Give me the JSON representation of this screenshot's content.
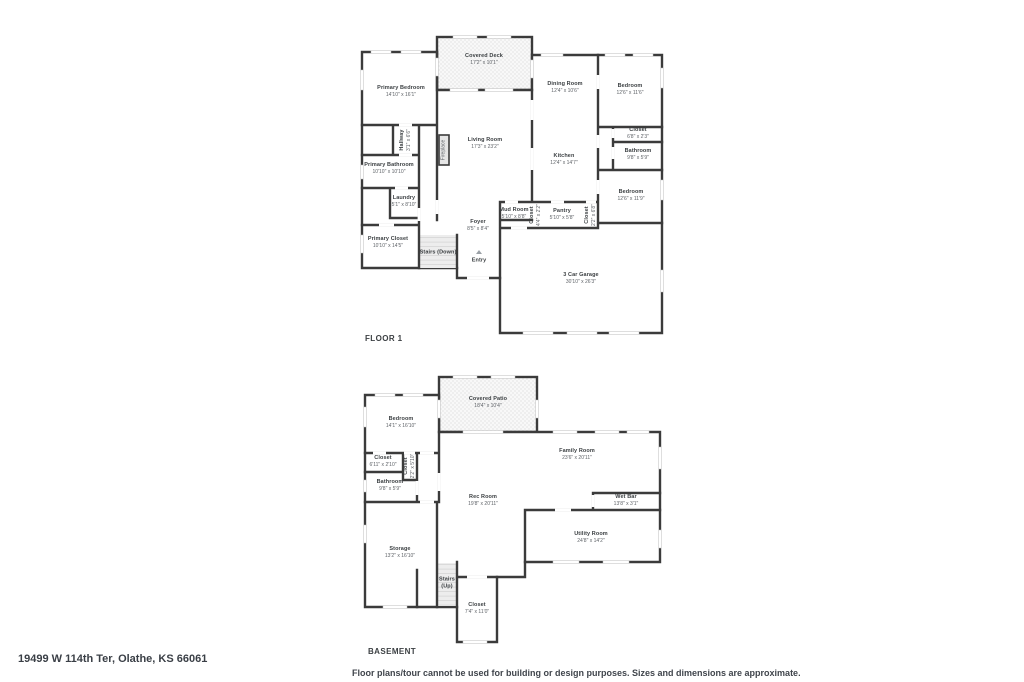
{
  "page": {
    "address": "19499 W 114th Ter, Olathe, KS 66061",
    "disclaimer": "Floor plans/tour cannot be used for building or design purposes. Sizes and dimensions are approximate."
  },
  "floor1": {
    "label": "FLOOR 1",
    "rooms": {
      "covered_deck": {
        "name": "Covered Deck",
        "dims": "17'2\" x 10'1\""
      },
      "primary_bedroom": {
        "name": "Primary Bedroom",
        "dims": "14'10\" x 16'1\""
      },
      "dining_room": {
        "name": "Dining Room",
        "dims": "12'4\" x 10'6\""
      },
      "bedroom_right": {
        "name": "Bedroom",
        "dims": "12'6\" x 11'6\""
      },
      "closet_right": {
        "name": "Closet",
        "dims": "6'8\" x 2'3\""
      },
      "bathroom_right": {
        "name": "Bathroom",
        "dims": "9'8\" x 5'9\""
      },
      "living_room": {
        "name": "Living Room",
        "dims": "17'3\" x 23'2\""
      },
      "kitchen": {
        "name": "Kitchen",
        "dims": "12'4\" x 14'7\""
      },
      "bedroom_lower_right": {
        "name": "Bedroom",
        "dims": "12'6\" x 11'9\""
      },
      "hallway": {
        "name": "Hallway",
        "dims": "3'1\" x 6'6\""
      },
      "primary_bathroom": {
        "name": "Primary Bathroom",
        "dims": "10'10\" x 10'10\""
      },
      "laundry": {
        "name": "Laundry",
        "dims": "5'1\" x 8'10\""
      },
      "primary_closet": {
        "name": "Primary Closet",
        "dims": "10'10\" x 14'5\""
      },
      "stairs_down": {
        "name": "Stairs (Down)",
        "dims": ""
      },
      "foyer": {
        "name": "Foyer",
        "dims": "8'5\" x 8'4\""
      },
      "entry": {
        "name": "Entry",
        "dims": ""
      },
      "mud_room": {
        "name": "Mud Room",
        "dims": "5'10\" x 8'8\""
      },
      "closet_mud": {
        "name": "Closet",
        "dims": "4'4\" x 2'2\""
      },
      "pantry": {
        "name": "Pantry",
        "dims": "5'10\" x 5'8\""
      },
      "closet_pantry": {
        "name": "Closet",
        "dims": "2'2\" x 6'8\""
      },
      "garage": {
        "name": "3 Car Garage",
        "dims": "30'10\" x 26'3\""
      },
      "fireplace": {
        "name": "Fireplace",
        "dims": ""
      }
    }
  },
  "basement": {
    "label": "BASEMENT",
    "rooms": {
      "covered_patio": {
        "name": "Covered Patio",
        "dims": "18'4\" x 10'4\""
      },
      "bedroom": {
        "name": "Bedroom",
        "dims": "14'1\" x 16'10\""
      },
      "closet_a": {
        "name": "Closet",
        "dims": "6'11\" x 2'10\""
      },
      "closet_b": {
        "name": "Closet",
        "dims": "2'2\" x 5'10\""
      },
      "bathroom": {
        "name": "Bathroom",
        "dims": "9'8\" x 5'9\""
      },
      "family_room": {
        "name": "Family Room",
        "dims": "23'6\" x 20'11\""
      },
      "rec_room": {
        "name": "Rec Room",
        "dims": "19'8\" x 20'11\""
      },
      "wet_bar": {
        "name": "Wet Bar",
        "dims": "13'8\" x 3'1\""
      },
      "utility_room": {
        "name": "Utility Room",
        "dims": "24'8\" x 14'2\""
      },
      "storage": {
        "name": "Storage",
        "dims": "13'2\" x 16'10\""
      },
      "stairs_up": {
        "name": "Stairs",
        "dims": "(Up)"
      },
      "closet_lower": {
        "name": "Closet",
        "dims": "7'4\" x 11'0\""
      }
    }
  }
}
